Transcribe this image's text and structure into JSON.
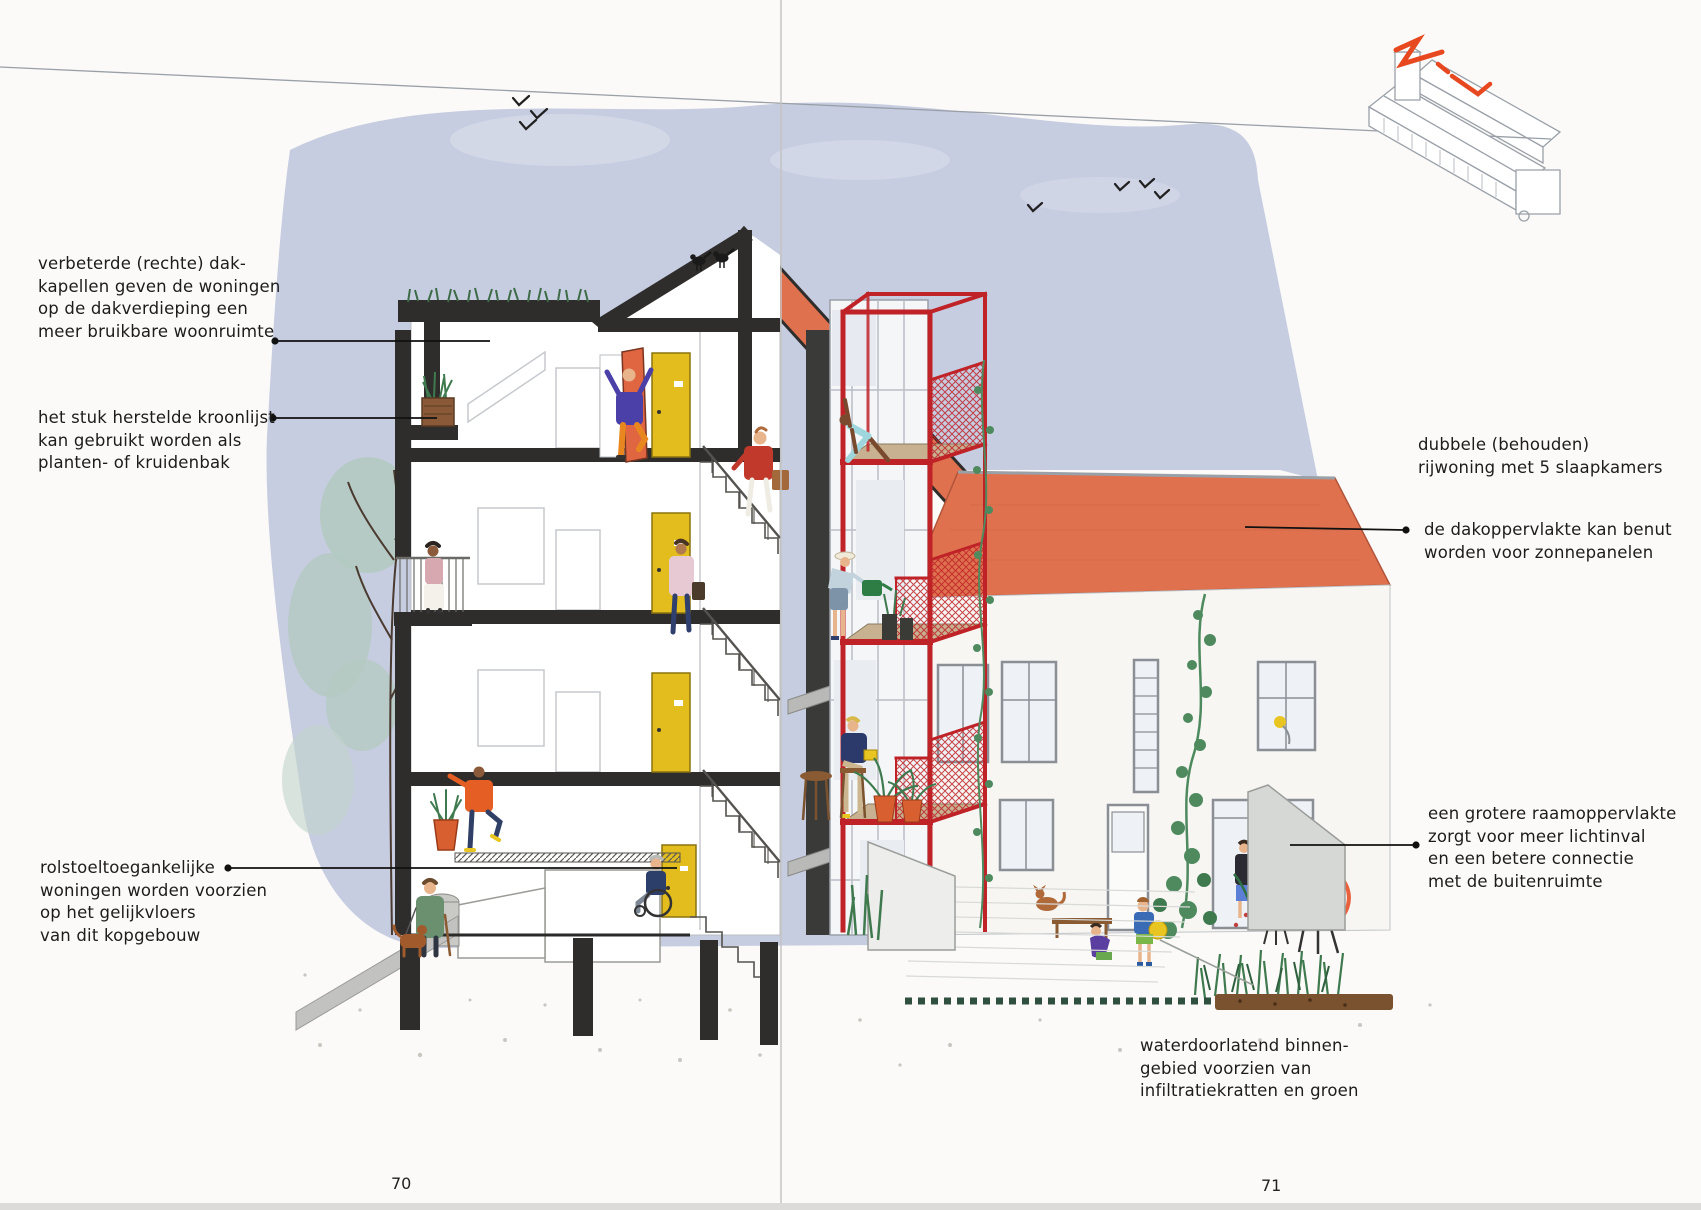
{
  "annotations": {
    "dormer": "verbeterde (rechte) dak-\nkapellen geven de woningen\nop de dakverdieping een\nmeer bruikbare woonruimte",
    "cornice": "het stuk herstelde kroonlijst\nkan gebruikt worden als\nplanten- of kruidenbak",
    "wheelchair": "rolstoeltoegankelijke\nwoningen worden voorzien\nop het gelijkvloers\nvan dit kopgebouw",
    "rowhouse": "dubbele (behouden)\nrijwoning met 5 slaapkamers",
    "roof_solar": "de dakoppervlakte kan benut\nworden voor zonnepanelen",
    "window": "een grotere raamoppervlakte\nzorgt voor meer lichtinval\nen een betere connectie\nmet de buitenruimte",
    "courtyard": "waterdoorlatend binnen-\ngebied voorzien van\ninfiltratiekratten en groen"
  },
  "page_numbers": {
    "left": "70",
    "right": "71"
  },
  "colors": {
    "paper": "#fbfaf8",
    "ink": "#1c1c1c",
    "sky": "#c7cde1",
    "cloud": "#d6dbe9",
    "roof-orange": "#e0714e",
    "steel-red": "#bf2328",
    "door-yellow": "#e3bc1d",
    "door-orange": "#e06642",
    "cut-black": "#2e2d2c",
    "wood": "#c8b190",
    "line-gray": "#8a8f96",
    "green-dark": "#3f7a4f",
    "green-soft": "#b3c9c0",
    "soil-brown": "#7a5230",
    "flower-purple": "#6253b8",
    "chair-orange": "#e8603c",
    "axo-red": "#e8481f"
  }
}
